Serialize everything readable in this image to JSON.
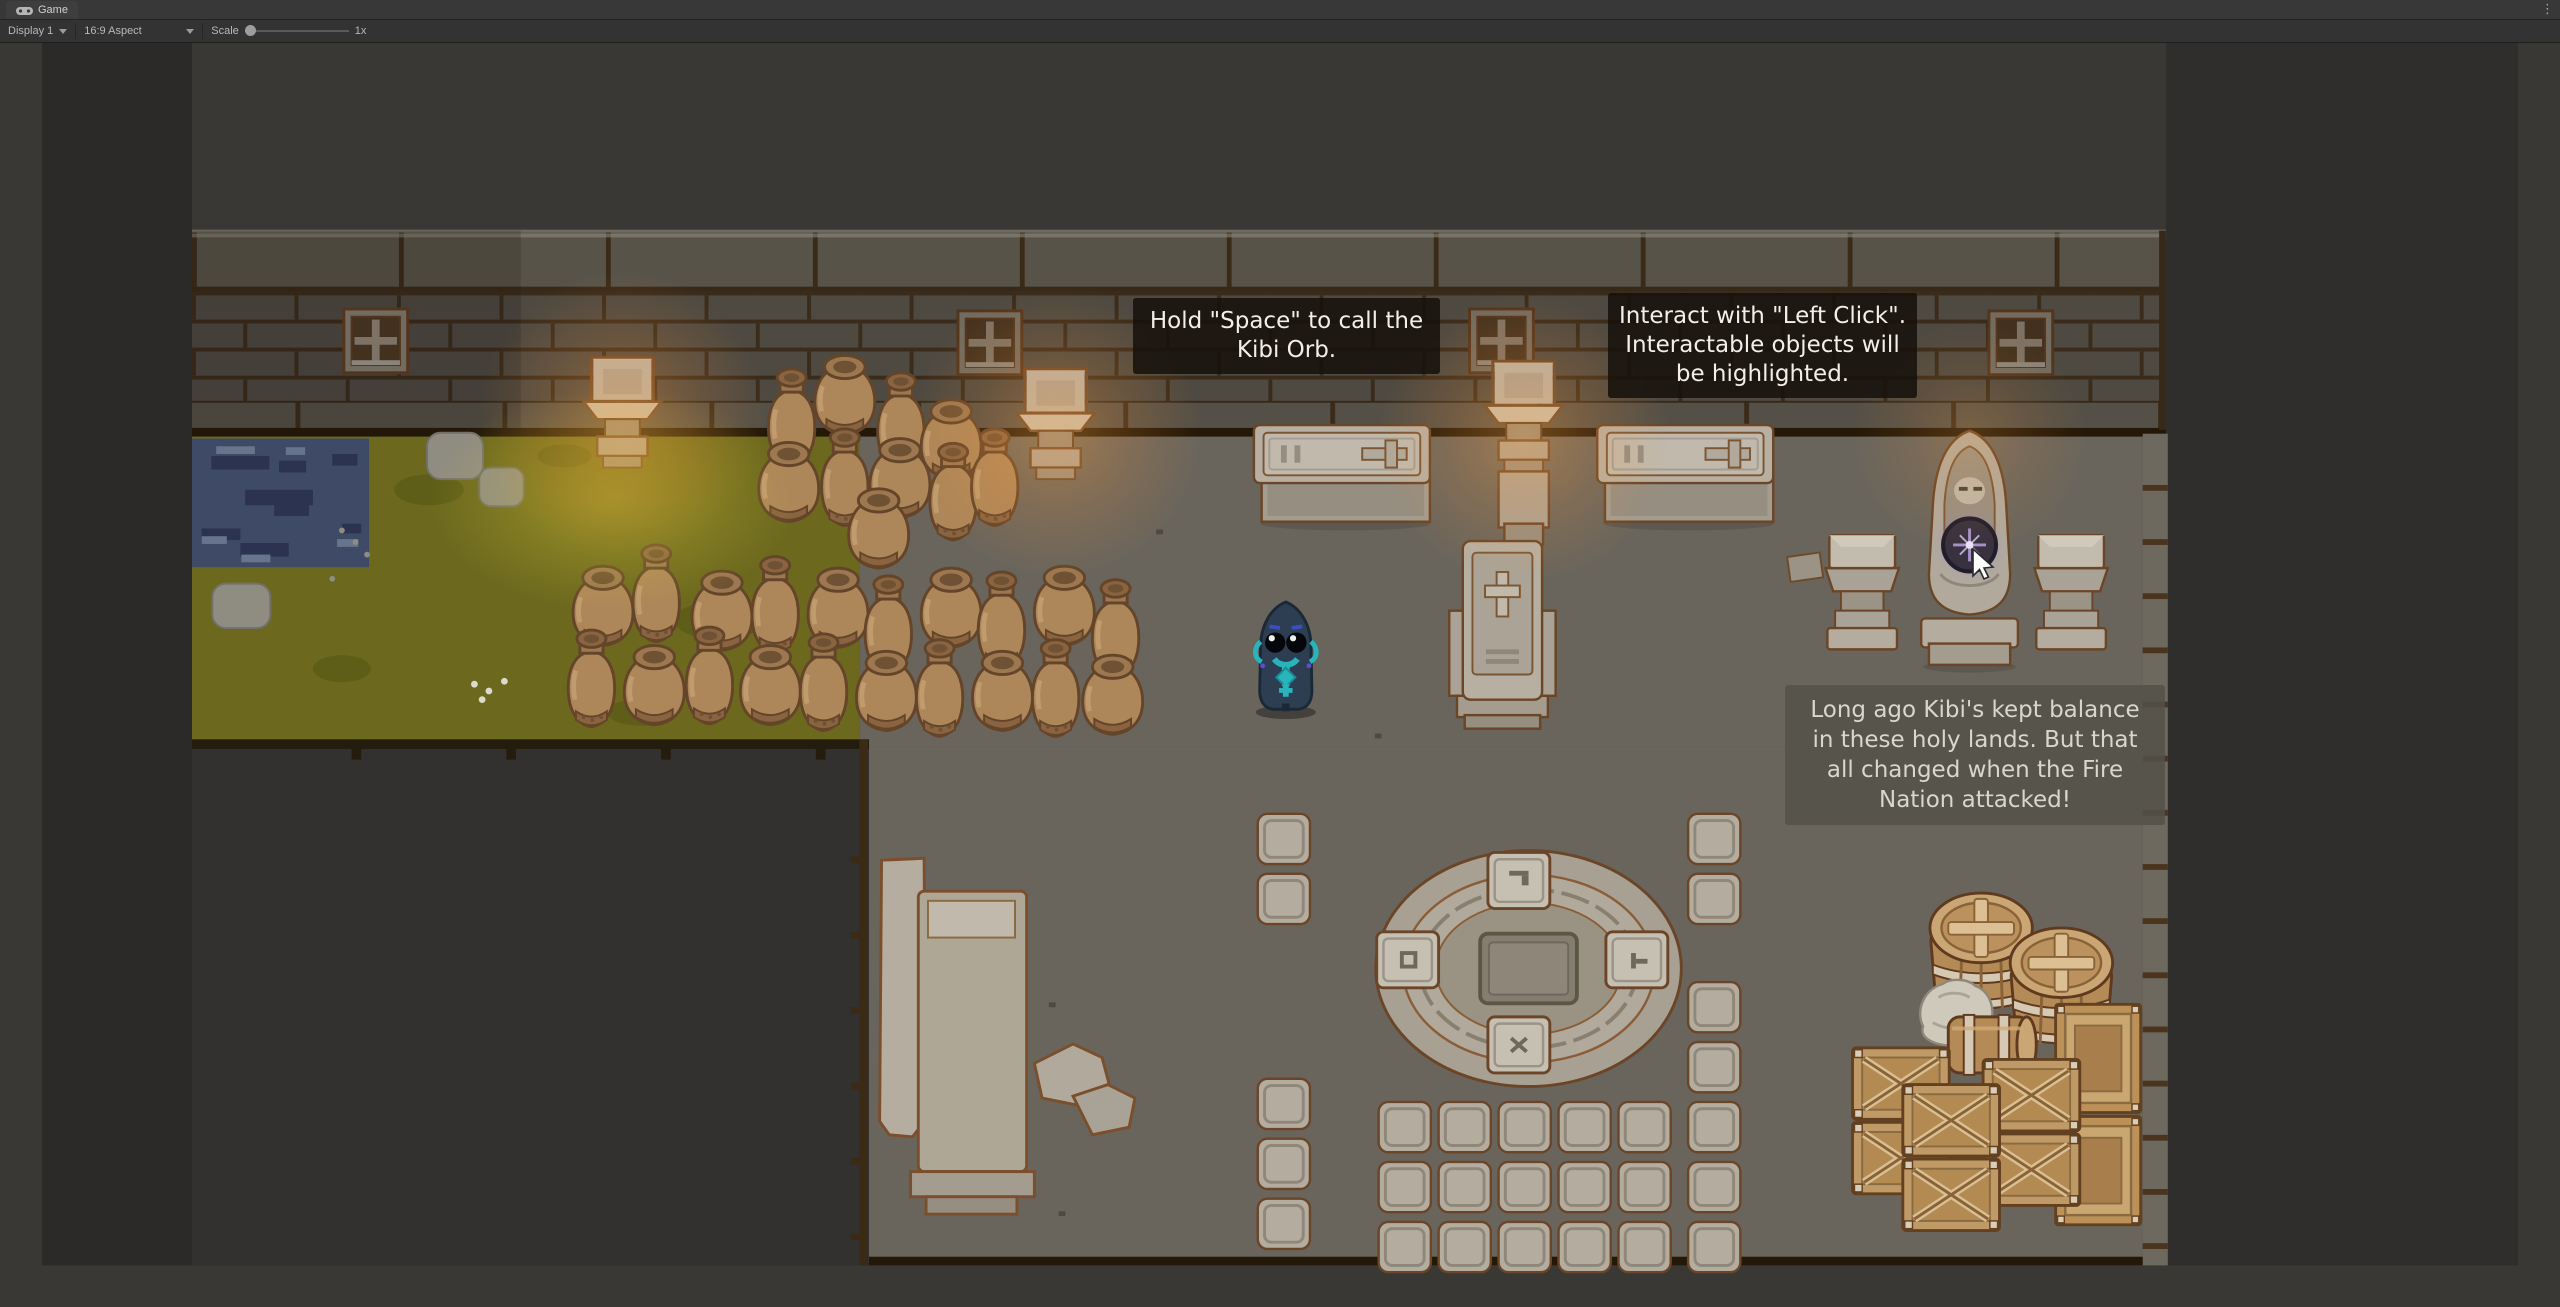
{
  "editor": {
    "tab_title": "Game",
    "toolbar": {
      "display": "Display 1",
      "aspect": "16:9 Aspect",
      "scale_label": "Scale",
      "scale_value": "1x",
      "maximize": "Maximize On Play",
      "mute": "Mute Audio",
      "stats": "Stats",
      "gizmos": "Gizmos"
    },
    "icons": {
      "tab_icon": "gamepad-icon",
      "menu_icon": "kebab-menu-icon",
      "dropdown_icon": "caret-down-icon"
    }
  },
  "game": {
    "hud": {
      "hint_space": "Hold \"Space\" to call the Kibi Orb.",
      "hint_interact": "Interact with \"Left Click\". Interactable objects will be highlighted.",
      "dialogue": "Long ago Kibi's kept balance in these holy lands. But that all changed when the Fire Nation attacked!"
    },
    "palette": {
      "floor": "#6a655c",
      "grass": "#6c691e",
      "pond": "#3e4a66",
      "wall_brick": "#4e4941",
      "wall_mortar": "#3a2b1a",
      "stone": "#b3ac9f",
      "stone_outline": "#6b4527",
      "wood_crate": "#c09a66",
      "pot_clay": "#ad8659",
      "character_body": "#2d3e53",
      "character_teal": "#28b4ba",
      "orb_sparkle": "#c9b6e4",
      "torch_glow": "#ffa642",
      "hint_bg": "rgba(22,17,11,0.87)",
      "dialogue_bg": "rgba(84,82,72,0.87)"
    }
  }
}
